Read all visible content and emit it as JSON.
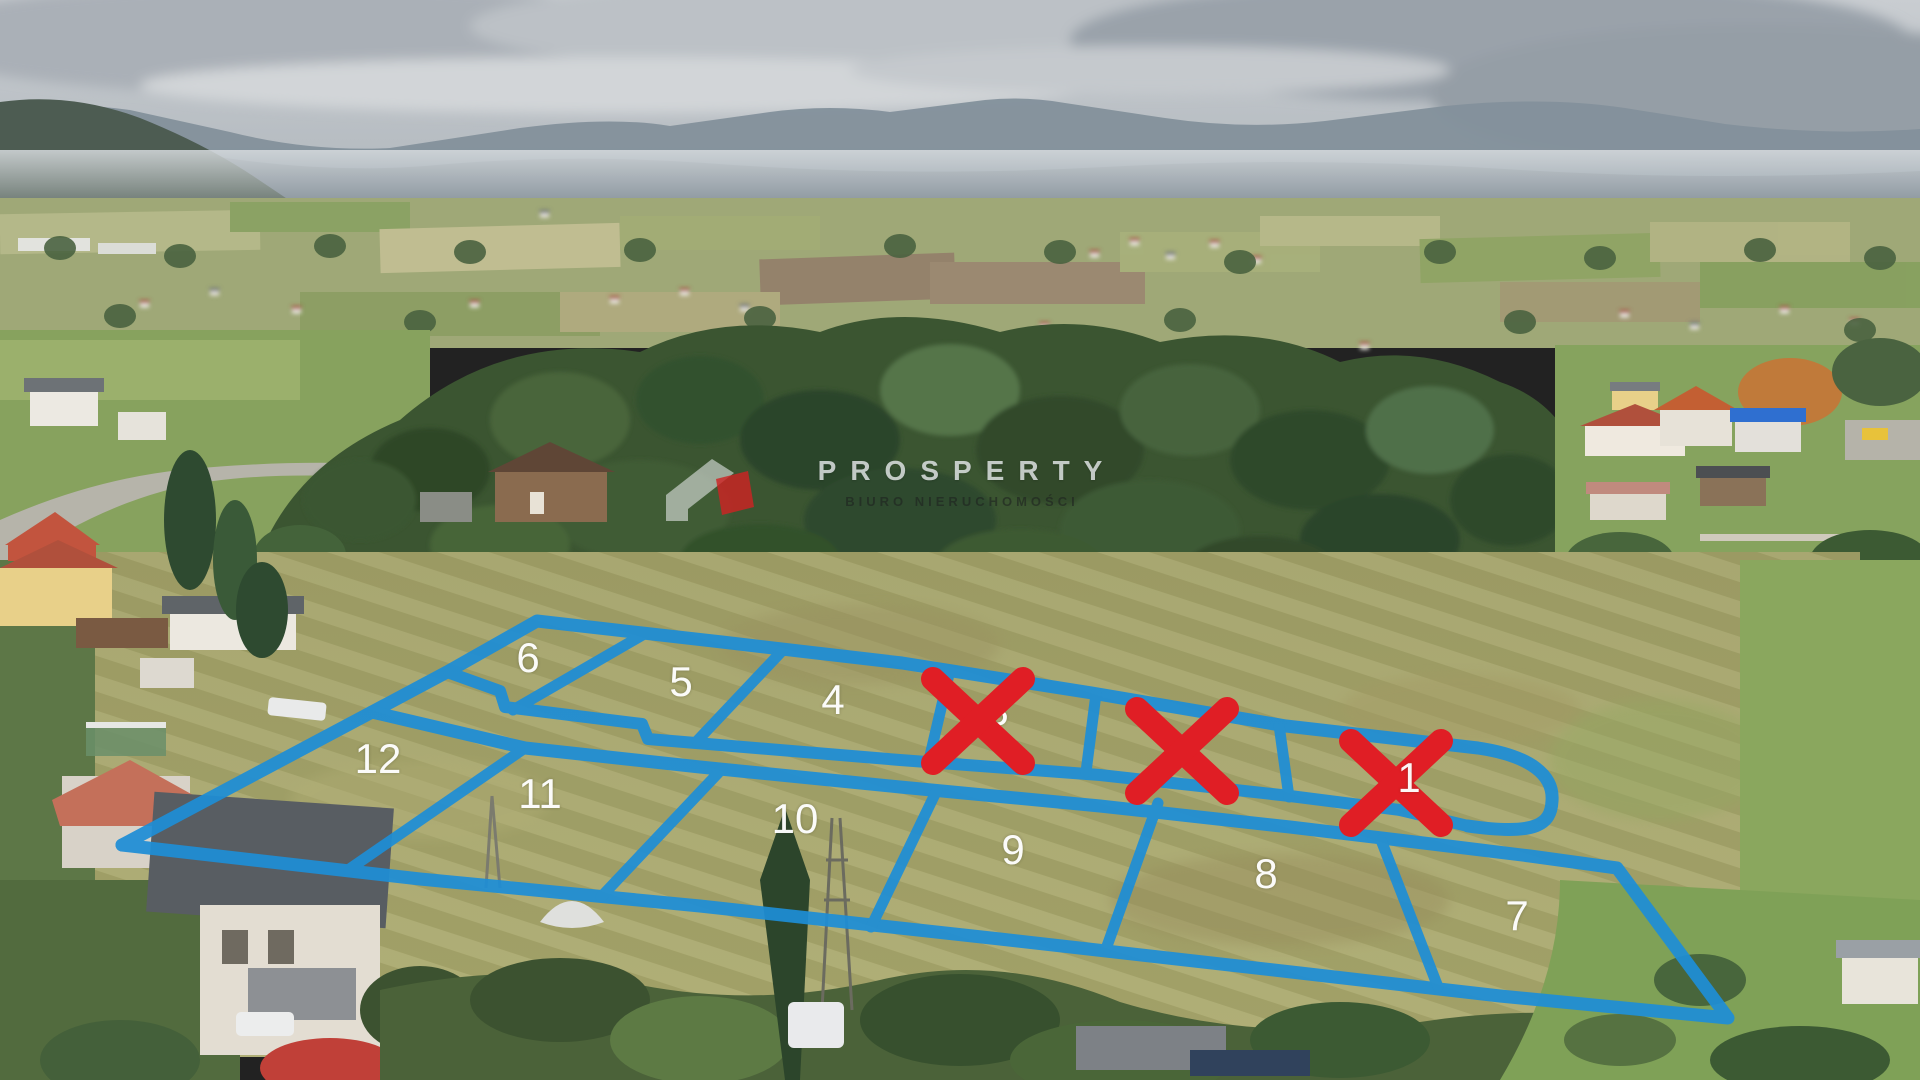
{
  "watermark": {
    "brand": "PROSPERTY",
    "subtitle": "BIURO NIERUCHOMOŚCI"
  },
  "colors": {
    "boundary_line": "#1e8ed6",
    "sold_cross": "#e01e25",
    "plot_number": "#ffffff"
  },
  "counts": {
    "total_plots": 12,
    "marked_sold": 3
  },
  "plots": [
    {
      "number": "1",
      "sold": true,
      "cross": {
        "x": 1396,
        "y": 783
      },
      "label": {
        "x": 1409,
        "y": 778,
        "visible": true,
        "layer": "over"
      }
    },
    {
      "number": "2",
      "sold": true,
      "cross": {
        "x": 1182,
        "y": 751
      },
      "label": {
        "visible": false
      }
    },
    {
      "number": "3",
      "sold": true,
      "cross": {
        "x": 978,
        "y": 721
      },
      "label": {
        "x": 997,
        "y": 711,
        "visible": true,
        "layer": "under"
      }
    },
    {
      "number": "4",
      "sold": false,
      "label": {
        "x": 833,
        "y": 700,
        "visible": true,
        "layer": "over"
      }
    },
    {
      "number": "5",
      "sold": false,
      "label": {
        "x": 681,
        "y": 682,
        "visible": true,
        "layer": "over"
      }
    },
    {
      "number": "6",
      "sold": false,
      "label": {
        "x": 528,
        "y": 658,
        "visible": true,
        "layer": "over"
      }
    },
    {
      "number": "7",
      "sold": false,
      "label": {
        "x": 1517,
        "y": 916,
        "visible": true,
        "layer": "over"
      }
    },
    {
      "number": "8",
      "sold": false,
      "label": {
        "x": 1266,
        "y": 874,
        "visible": true,
        "layer": "over"
      }
    },
    {
      "number": "9",
      "sold": false,
      "label": {
        "x": 1013,
        "y": 850,
        "visible": true,
        "layer": "over"
      }
    },
    {
      "number": "10",
      "sold": false,
      "label": {
        "x": 795,
        "y": 819,
        "visible": true,
        "layer": "over"
      }
    },
    {
      "number": "11",
      "sold": false,
      "label": {
        "x": 540,
        "y": 794,
        "visible": true,
        "layer": "over"
      }
    },
    {
      "number": "12",
      "sold": false,
      "label": {
        "x": 378,
        "y": 759,
        "visible": true,
        "layer": "over"
      }
    }
  ]
}
